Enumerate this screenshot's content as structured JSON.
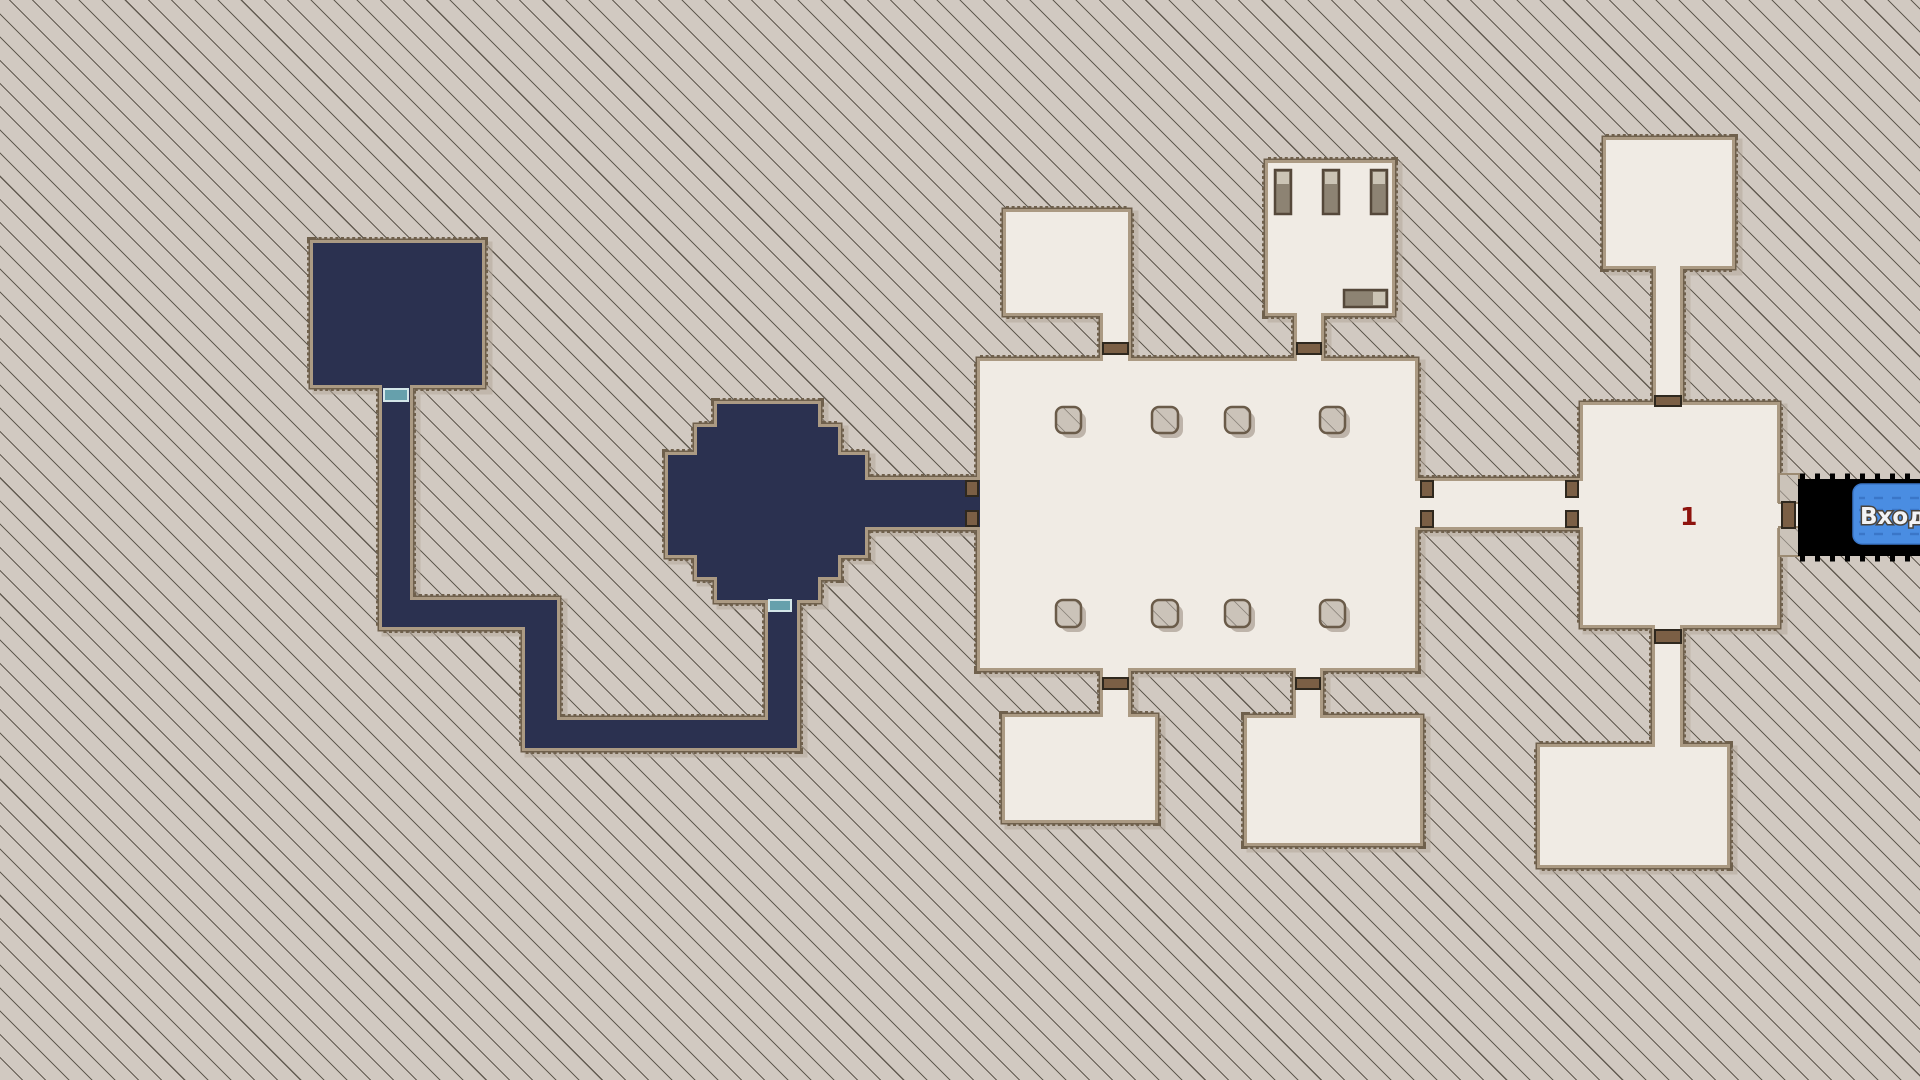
{
  "title": "Dungeon map view",
  "labels": {
    "entrance": "Вход",
    "room_number": "1"
  },
  "colors": {
    "background": "#d1c9c1",
    "hatch_line": "#625b51",
    "room_fill": "#f0ebe4",
    "dark_room_fill": "#2b3150",
    "wall_edge": "#6f604c",
    "wall_band": "#ab9a83",
    "door_brown": "#7b5f45",
    "door_teal": "#66a0ac",
    "tunnel": "#000000",
    "entrance_bg": "#4a8de2",
    "entrance_text": "#f2f3f5",
    "room_number_color": "#8e130d"
  },
  "rooms": [
    "dark-square-room",
    "dark-octagon-room",
    "zigzag-dark-corridor",
    "pillar-hall",
    "small-room-top-left",
    "barracks-room",
    "room-top-right",
    "room-1",
    "room-bottom-left",
    "room-bottom-middle",
    "room-bottom-right",
    "entrance-tunnel"
  ],
  "features": {
    "pillars_in_hall": 8,
    "beds_in_barracks": 4,
    "teal_doors": 2,
    "brown_doors": 6,
    "brown_doorposts": 7
  }
}
